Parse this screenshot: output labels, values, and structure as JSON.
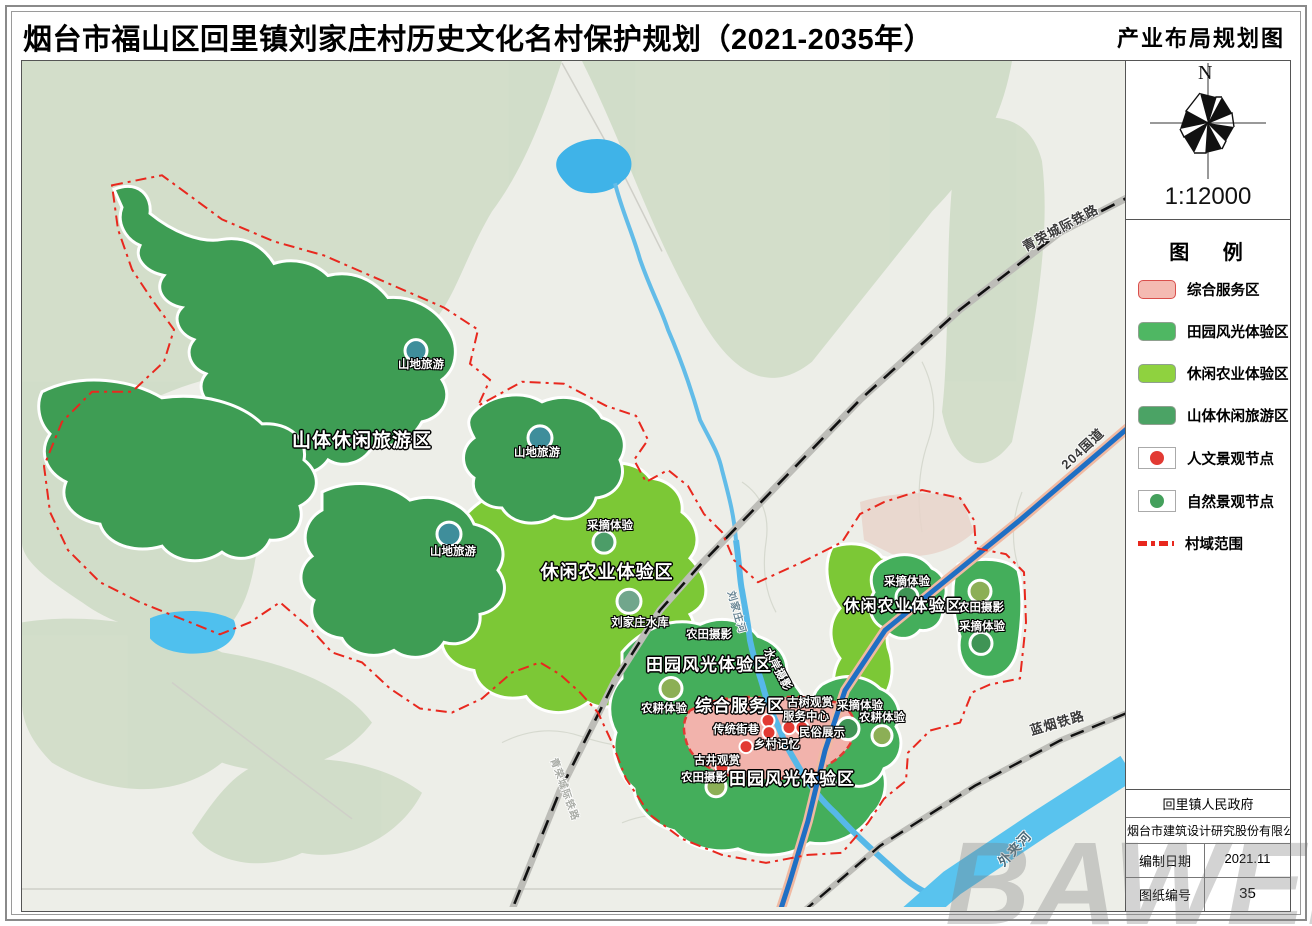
{
  "title": "烟台市福山区回里镇刘家庄村历史文化名村保护规划（2021-2035年）",
  "map_name": "产业布局规划图",
  "compass": {
    "north_label": "N",
    "scale": "1:12000"
  },
  "legend": {
    "title": "图  例",
    "zones": [
      {
        "label": "综合服务区",
        "fill": "#f4bab2",
        "border": "#d94f4c"
      },
      {
        "label": "田园风光体验区",
        "fill": "#4fb763",
        "border": "#8fa08f"
      },
      {
        "label": "休闲农业体验区",
        "fill": "#8fd23f",
        "border": "#8fa08f"
      },
      {
        "label": "山体休闲旅游区",
        "fill": "#4ba365",
        "border": "#8fa08f"
      }
    ],
    "nodes": [
      {
        "label": "人文景观节点",
        "color": "#e23a33"
      },
      {
        "label": "自然景观节点",
        "color": "#44a05c"
      }
    ],
    "boundary": {
      "label": "村域范围",
      "color": "#e8281e"
    }
  },
  "info_table": {
    "span_rows": [
      "回里镇人民政府",
      "烟台市建筑设计研究股份有限公司"
    ],
    "pair_rows": [
      {
        "label": "编制日期",
        "value": "2021.11"
      },
      {
        "label": "图纸编号",
        "value": "35"
      }
    ]
  },
  "watermark": "BAWEI",
  "map": {
    "zone_labels": [
      {
        "text": "山体休闲旅游区",
        "x": 340,
        "y": 378,
        "size": 19
      },
      {
        "text": "休闲农业体验区",
        "x": 585,
        "y": 510,
        "size": 18
      },
      {
        "text": "田园风光体验区",
        "x": 687,
        "y": 602,
        "size": 17
      },
      {
        "text": "综合服务区",
        "x": 718,
        "y": 643,
        "size": 17
      },
      {
        "text": "休闲农业体验区",
        "x": 881,
        "y": 543,
        "size": 16
      },
      {
        "text": "田园风光体验区",
        "x": 770,
        "y": 716,
        "size": 17
      }
    ],
    "site_labels": [
      {
        "text": "山地旅游",
        "x": 399,
        "y": 303
      },
      {
        "text": "山地旅游",
        "x": 515,
        "y": 391
      },
      {
        "text": "山地旅游",
        "x": 431,
        "y": 490
      },
      {
        "text": "采摘体验",
        "x": 588,
        "y": 464
      },
      {
        "text": "刘家庄水库",
        "x": 618,
        "y": 561
      },
      {
        "text": "农田摄影",
        "x": 687,
        "y": 573
      },
      {
        "text": "农耕体验",
        "x": 642,
        "y": 647
      },
      {
        "text": "古树观赏",
        "x": 788,
        "y": 641
      },
      {
        "text": "服务中心",
        "x": 784,
        "y": 655
      },
      {
        "text": "传统街巷",
        "x": 714,
        "y": 668
      },
      {
        "text": "民俗展示",
        "x": 800,
        "y": 671
      },
      {
        "text": "乡村记忆",
        "x": 755,
        "y": 683
      },
      {
        "text": "古井观赏",
        "x": 695,
        "y": 699
      },
      {
        "text": "农田摄影",
        "x": 682,
        "y": 716
      },
      {
        "text": "采摘体验",
        "x": 885,
        "y": 520
      },
      {
        "text": "农田摄影",
        "x": 959,
        "y": 546
      },
      {
        "text": "采摘体验",
        "x": 960,
        "y": 565
      },
      {
        "text": "采摘体验",
        "x": 838,
        "y": 644
      },
      {
        "text": "农耕体验",
        "x": 860,
        "y": 656
      },
      {
        "text": "水岸摄影",
        "x": 756,
        "y": 608,
        "rot": 62
      }
    ],
    "transport_labels": [
      {
        "text": "青荣城际铁路",
        "x": 1038,
        "y": 166,
        "rot": -28
      },
      {
        "text": "204国道",
        "x": 1060,
        "y": 387,
        "rot": -43
      },
      {
        "text": "蓝烟铁路",
        "x": 1035,
        "y": 661,
        "rot": -16
      },
      {
        "text": "外夹河",
        "x": 992,
        "y": 787,
        "rot": -47,
        "color": "#4a6b7a"
      },
      {
        "text": "刘家庄河",
        "x": 716,
        "y": 551,
        "rot": 74,
        "color": "#6b8795",
        "size": 10
      },
      {
        "text": "青荣城际铁路",
        "x": 544,
        "y": 728,
        "rot": 70,
        "color": "#a9aca6",
        "size": 10
      }
    ],
    "nature_nodes": [
      {
        "x": 394,
        "y": 289,
        "r": 11,
        "color": "#3f8e9b"
      },
      {
        "x": 518,
        "y": 376,
        "r": 12,
        "color": "#3f8e9b"
      },
      {
        "x": 427,
        "y": 472,
        "r": 12,
        "color": "#3f8e9b"
      },
      {
        "x": 582,
        "y": 480,
        "r": 11,
        "color": "#4c9d68"
      },
      {
        "x": 607,
        "y": 539,
        "r": 12,
        "color": "#71a68c"
      },
      {
        "x": 649,
        "y": 626,
        "r": 11,
        "color": "#8caf56"
      },
      {
        "x": 694,
        "y": 724,
        "r": 10,
        "color": "#8caf56"
      },
      {
        "x": 885,
        "y": 535,
        "r": 11,
        "color": "#3f9455"
      },
      {
        "x": 958,
        "y": 529,
        "r": 11,
        "color": "#8caf56"
      },
      {
        "x": 959,
        "y": 581,
        "r": 11,
        "color": "#3f9455"
      },
      {
        "x": 826,
        "y": 666,
        "r": 11,
        "color": "#3f9455"
      },
      {
        "x": 860,
        "y": 673,
        "r": 10,
        "color": "#8caf56"
      }
    ],
    "culture_nodes": [
      {
        "x": 746,
        "y": 658
      },
      {
        "x": 747,
        "y": 670
      },
      {
        "x": 724,
        "y": 684
      },
      {
        "x": 767,
        "y": 665
      },
      {
        "x": 780,
        "y": 665
      },
      {
        "x": 700,
        "y": 705
      }
    ],
    "culture_color": "#e23a33"
  }
}
